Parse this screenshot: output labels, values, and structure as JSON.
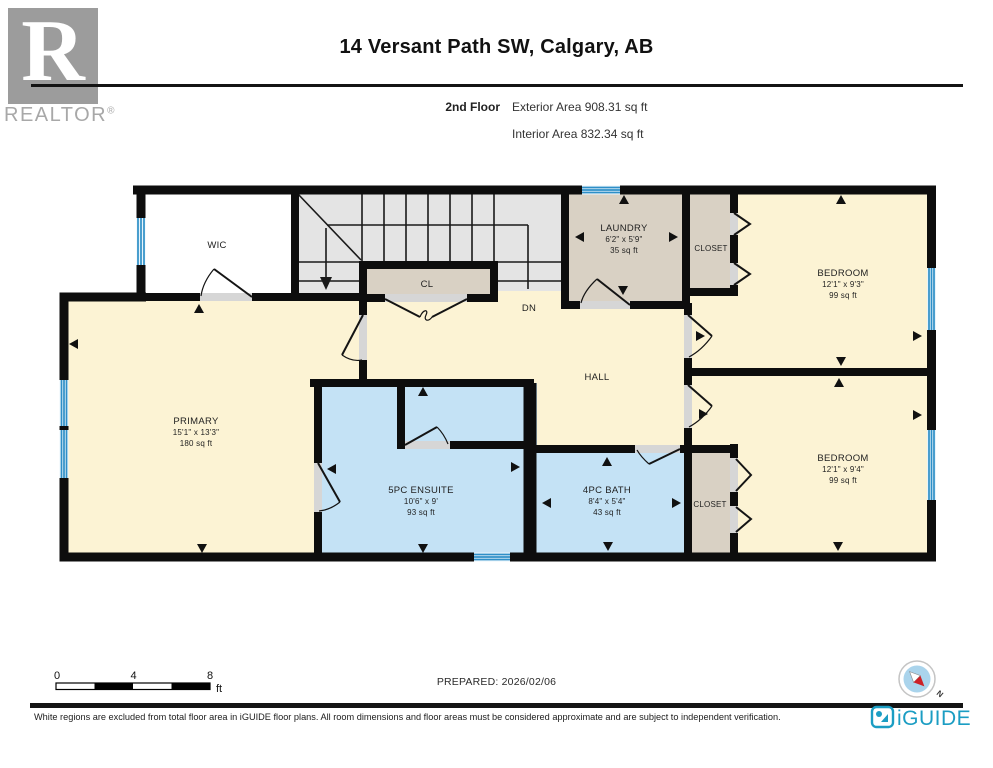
{
  "header": {
    "title": "14 Versant Path SW, Calgary, AB",
    "floor_label": "2nd Floor",
    "exterior_area": "Exterior Area 908.31 sq ft",
    "interior_area": "Interior Area 832.34 sq ft",
    "realtor_logo_letter": "R",
    "realtor_logo_text": "REALTOR",
    "registered_mark": "®"
  },
  "plan": {
    "rooms": {
      "wic": {
        "name": "WIC"
      },
      "laundry": {
        "name": "LAUNDRY",
        "dims": "6'2\" x 5'9\"",
        "area": "35 sq ft"
      },
      "closet_top": {
        "name": "CLOSET"
      },
      "bedroom1": {
        "name": "BEDROOM",
        "dims": "12'1\" x 9'3\"",
        "area": "99 sq ft"
      },
      "cl": {
        "name": "CL"
      },
      "hall": {
        "name": "HALL"
      },
      "primary": {
        "name": "PRIMARY",
        "dims": "15'1\" x 13'3\"",
        "area": "180 sq ft"
      },
      "ensuite": {
        "name": "5PC ENSUITE",
        "dims": "10'6\" x 9'",
        "area": "93 sq ft"
      },
      "bath": {
        "name": "4PC BATH",
        "dims": "8'4\" x 5'4\"",
        "area": "43 sq ft"
      },
      "closet_bottom": {
        "name": "CLOSET"
      },
      "bedroom2": {
        "name": "BEDROOM",
        "dims": "12'1\" x 9'4\"",
        "area": "99 sq ft"
      }
    },
    "annotations": {
      "down_label": "DN"
    },
    "colors": {
      "room_yellow": "#fcf3d4",
      "room_tan": "#d9d1c4",
      "room_blue": "#c4e2f5",
      "stairs_gray": "#e4e4e4",
      "window_blue": "#2e8fc7",
      "wall_black": "#0d0d0d",
      "brand_teal": "#1b9dc3",
      "compass_red": "#cc2127"
    }
  },
  "scale_bar": {
    "ticks": [
      "0",
      "4",
      "8"
    ],
    "unit": "ft"
  },
  "prepared_label": "PREPARED: 2026/02/06",
  "compass": {
    "north_label": "N"
  },
  "footer": {
    "disclaimer": "White regions are excluded from total floor area in iGUIDE floor plans. All room dimensions and floor areas must be considered approximate and are subject to independent verification.",
    "brand": "iGUIDE"
  }
}
